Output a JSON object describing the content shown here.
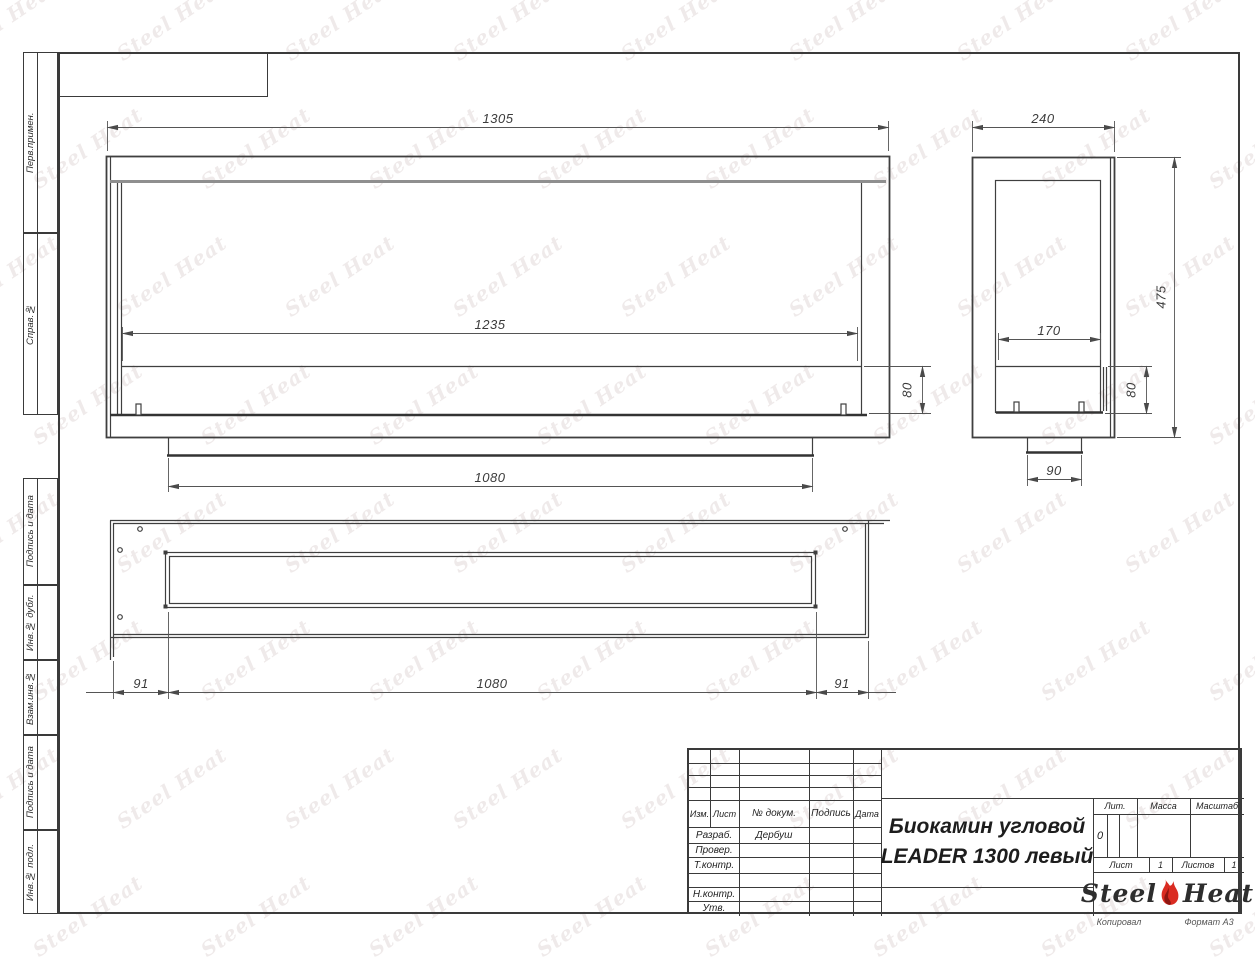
{
  "page": {
    "copied_label": "Копировал",
    "format_label": "Формат А3"
  },
  "side_strip": {
    "items": [
      {
        "label": "Перв.примен."
      },
      {
        "label": "Справ.№"
      },
      {
        "label": "Подпись и дата"
      },
      {
        "label": "Инв.№ дубл."
      },
      {
        "label": "Взам.инв.№"
      },
      {
        "label": "Подпись и дата"
      },
      {
        "label": "Инв.№ подл."
      }
    ]
  },
  "dimensions": {
    "front_width": "1305",
    "front_opening_width": "1235",
    "front_burner_height": "80",
    "front_base_width": "1080",
    "side_depth": "240",
    "side_height": "475",
    "side_opening_depth": "170",
    "side_burner_height": "80",
    "side_foot_width": "90",
    "plan_left_offset": "91",
    "plan_slot_width": "1080",
    "plan_right_offset": "91"
  },
  "title_block": {
    "columns": {
      "izm": "Изм.",
      "list": "Лист",
      "doc": "№ докум.",
      "sign": "Подпись",
      "date": "Дата"
    },
    "rows": [
      {
        "label": "Разраб.",
        "value": "Дербуш"
      },
      {
        "label": "Провер.",
        "value": ""
      },
      {
        "label": "Т.контр.",
        "value": ""
      },
      {
        "label": "Н.контр.",
        "value": ""
      },
      {
        "label": "Утв.",
        "value": ""
      }
    ],
    "title_line1": "Биокамин угловой",
    "title_line2": "LEADER 1300 левый",
    "lit_label": "Лит.",
    "lit_value": "0",
    "mass_label": "Масса",
    "scale_label": "Масштаб",
    "sheet_label": "Лист",
    "sheet_number": "1",
    "sheets_label": "Листов",
    "sheets_total": "1",
    "logo_steel": "Steel",
    "logo_heat": "Heat"
  },
  "watermark": {
    "steel": "Steel",
    "heat": "Heat",
    "color": "#cfc0c0"
  }
}
